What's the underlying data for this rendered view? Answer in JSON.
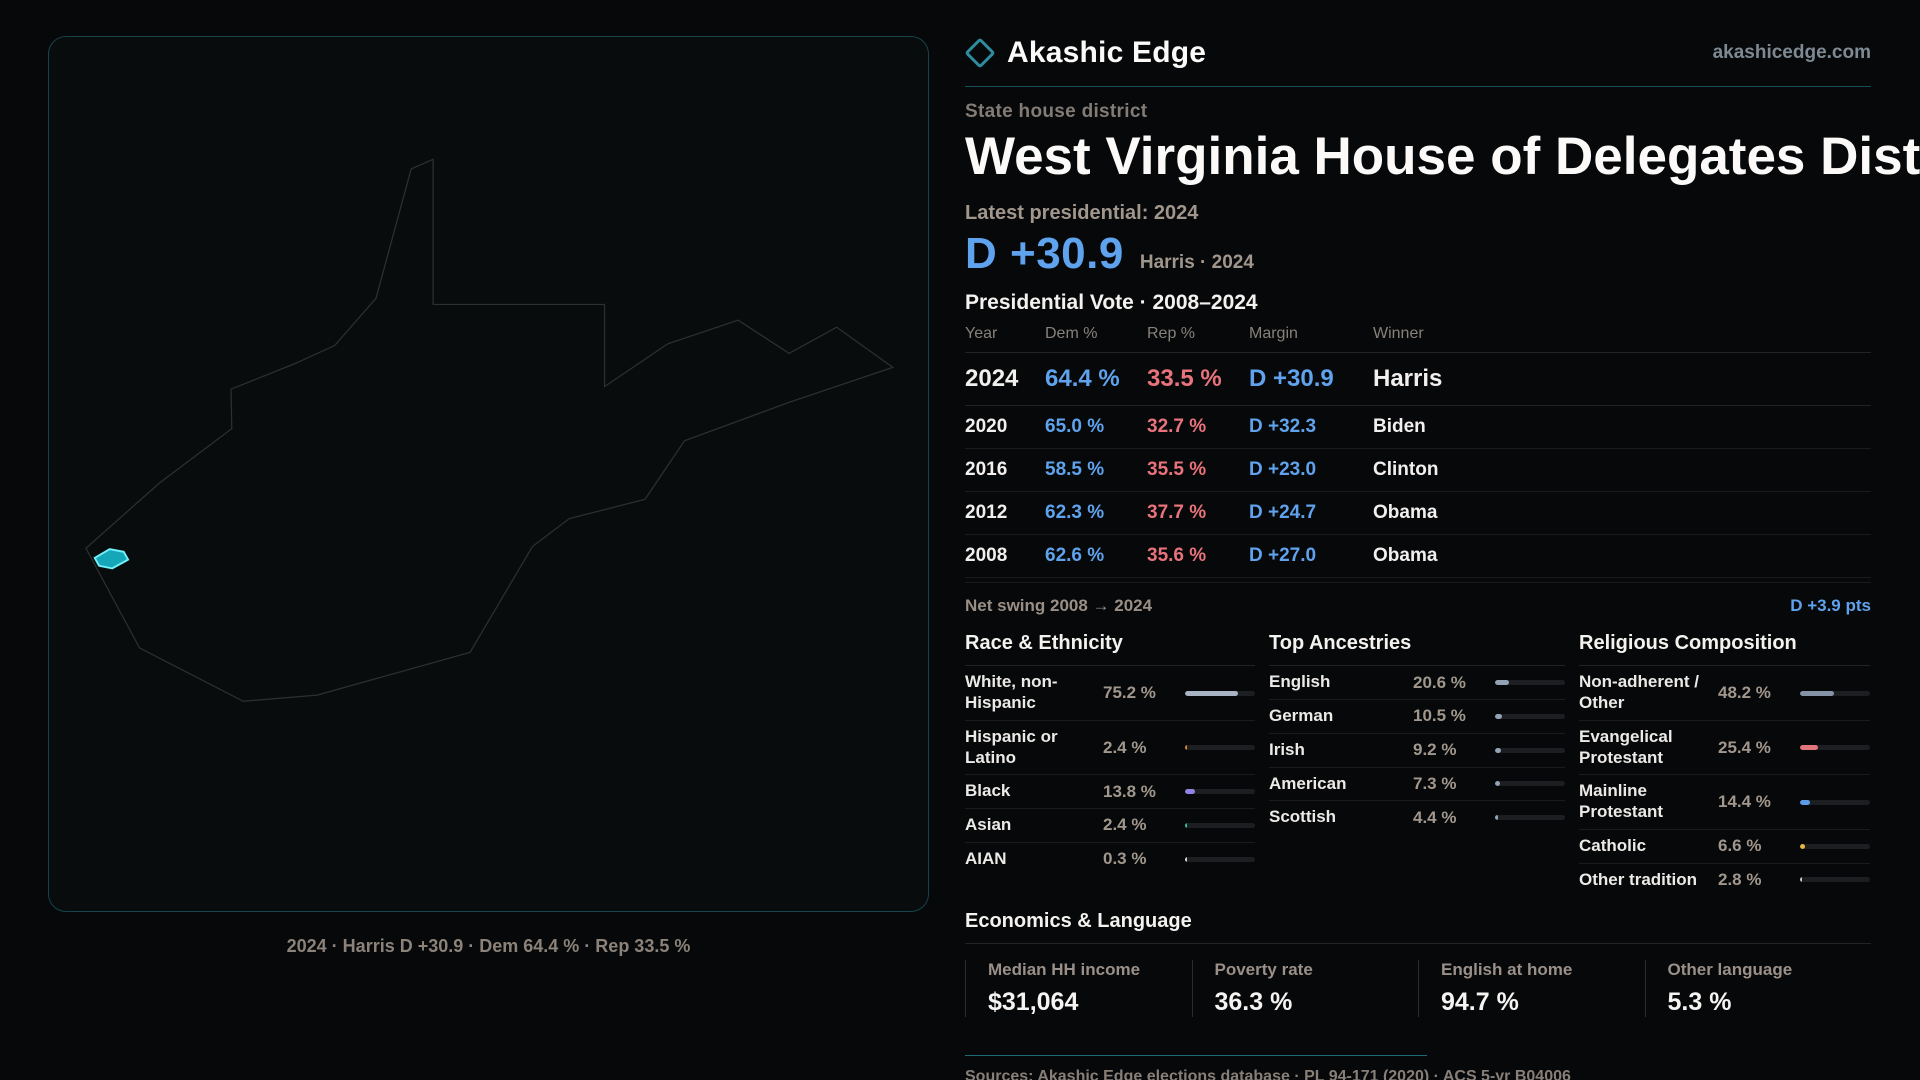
{
  "brand": {
    "name": "Akashic Edge",
    "domain": "akashicedge.com",
    "accent_teal": "#2d8c9e"
  },
  "header": {
    "kicker": "State house district",
    "title": "West Virginia House of Delegates District 25"
  },
  "latest": {
    "label": "Latest presidential: 2024",
    "margin": "D +30.9",
    "sub": "Harris · 2024"
  },
  "pres_table": {
    "title": "Presidential Vote · 2008–2024",
    "columns": [
      "Year",
      "Dem %",
      "Rep %",
      "Margin",
      "Winner"
    ],
    "rows": [
      {
        "year": "2024",
        "dem": "64.4 %",
        "rep": "33.5 %",
        "margin": "D +30.9",
        "winner": "Harris"
      },
      {
        "year": "2020",
        "dem": "65.0 %",
        "rep": "32.7 %",
        "margin": "D +32.3",
        "winner": "Biden"
      },
      {
        "year": "2016",
        "dem": "58.5 %",
        "rep": "35.5 %",
        "margin": "D +23.0",
        "winner": "Clinton"
      },
      {
        "year": "2012",
        "dem": "62.3 %",
        "rep": "37.7 %",
        "margin": "D +24.7",
        "winner": "Obama"
      },
      {
        "year": "2008",
        "dem": "62.6 %",
        "rep": "35.6 %",
        "margin": "D +27.0",
        "winner": "Obama"
      }
    ],
    "dem_color": "#5fa3ee",
    "rep_color": "#e8737c",
    "net_swing_label": "Net swing 2008 → 2024",
    "net_swing_value": "D +3.9 pts"
  },
  "demographics": {
    "race": {
      "title": "Race & Ethnicity",
      "rows": [
        {
          "label": "White, non-Hispanic",
          "value": "75.2 %",
          "pct": 75.2,
          "color": "#a8b4c4"
        },
        {
          "label": "Hispanic or Latino",
          "value": "2.4 %",
          "pct": 2.4,
          "color": "#d78e2e"
        },
        {
          "label": "Black",
          "value": "13.8 %",
          "pct": 13.8,
          "color": "#8f83e6"
        },
        {
          "label": "Asian",
          "value": "2.4 %",
          "pct": 2.4,
          "color": "#2ebfa0"
        },
        {
          "label": "AIAN",
          "value": "0.3 %",
          "pct": 0.3,
          "color": "#d8d4cf"
        }
      ]
    },
    "ancestry": {
      "title": "Top Ancestries",
      "rows": [
        {
          "label": "English",
          "value": "20.6 %",
          "pct": 20.6,
          "color": "#93a2b5"
        },
        {
          "label": "German",
          "value": "10.5 %",
          "pct": 10.5,
          "color": "#93a2b5"
        },
        {
          "label": "Irish",
          "value": "9.2 %",
          "pct": 9.2,
          "color": "#93a2b5"
        },
        {
          "label": "American",
          "value": "7.3 %",
          "pct": 7.3,
          "color": "#93a2b5"
        },
        {
          "label": "Scottish",
          "value": "4.4 %",
          "pct": 4.4,
          "color": "#93a2b5"
        }
      ]
    },
    "religion": {
      "title": "Religious Composition",
      "rows": [
        {
          "label": "Non-adherent / Other",
          "value": "48.2 %",
          "pct": 48.2,
          "color": "#8593a6"
        },
        {
          "label": "Evangelical Protestant",
          "value": "25.4 %",
          "pct": 25.4,
          "color": "#e0757b"
        },
        {
          "label": "Mainline Protestant",
          "value": "14.4 %",
          "pct": 14.4,
          "color": "#5b9ce8"
        },
        {
          "label": "Catholic",
          "value": "6.6 %",
          "pct": 6.6,
          "color": "#e9b93f"
        },
        {
          "label": "Other tradition",
          "value": "2.8 %",
          "pct": 2.8,
          "color": "#cfcac4"
        }
      ]
    }
  },
  "economics": {
    "title": "Economics & Language",
    "stats": [
      {
        "label": "Median HH income",
        "value": "$31,064"
      },
      {
        "label": "Poverty rate",
        "value": "36.3 %"
      },
      {
        "label": "English at home",
        "value": "94.7 %"
      },
      {
        "label": "Other language",
        "value": "5.3 %"
      }
    ]
  },
  "footer": {
    "sources": "Sources: Akashic Edge elections database · PL 94-171 (2020) · ACS 5-yr B04006",
    "url": "akashicedge.com/state-house/wv-hd-25"
  },
  "map": {
    "caption": "2024 · Harris D +30.9 · Dem 64.4 % · Rep 33.5 %",
    "outline_color": "#2e2f31",
    "highlight_fill": "#19c2d8",
    "highlight_stroke": "#6ff0fb"
  }
}
